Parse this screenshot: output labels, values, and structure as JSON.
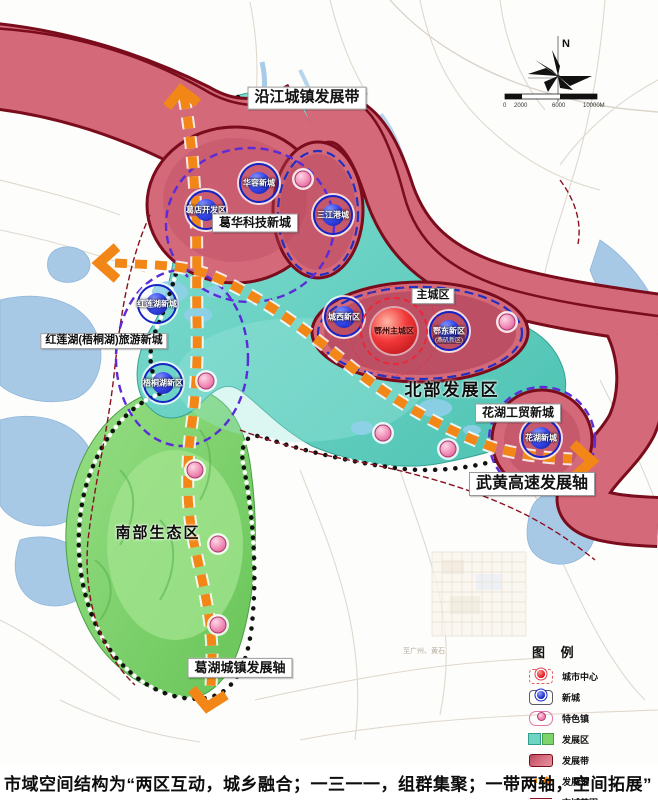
{
  "map": {
    "belt_label": "沿江城镇发展带",
    "regions": {
      "main_city": "主城区",
      "north": "北部发展区",
      "south": "南部生态区"
    },
    "clusters": {
      "gehua": "葛华科技新城",
      "honglianhu": "红莲湖(梧桐湖)旅游新城",
      "huahu": "花湖工贸新城"
    },
    "axes": {
      "wuhuang": "武黄高速发展轴",
      "gehu": "葛湖城镇发展轴"
    },
    "city_center": {
      "label": "鄂州主城区"
    },
    "new_cities": [
      {
        "label": "葛店开发区"
      },
      {
        "label": "华容新城"
      },
      {
        "label": "三江港城"
      },
      {
        "label": "城西新区"
      },
      {
        "label": "鄂东新区",
        "sub_label": "(燕矶新区)"
      },
      {
        "label": "红莲湖新城"
      },
      {
        "label": "梧桐湖新区"
      },
      {
        "label": "花湖新城"
      }
    ],
    "road_label": "至广州、黄石"
  },
  "compass": {
    "north": "N"
  },
  "scalebar": {
    "ticks": [
      "0",
      "2000",
      "6000",
      "10000M"
    ]
  },
  "legend": {
    "title": "图 例",
    "items": [
      {
        "label": "城市中心"
      },
      {
        "label": "新城"
      },
      {
        "label": "特色镇"
      },
      {
        "label": "发展区"
      },
      {
        "label": "发展带"
      },
      {
        "label": "发展轴"
      },
      {
        "label": "市域范围"
      }
    ]
  },
  "caption": "市域空间结构为“两区互动，城乡融合；一三一一，组群集聚；一带两轴，空间拓展”",
  "colors": {
    "belt_fill": "#d4697a",
    "belt_border": "#7a0c1c",
    "north_region": "#5ecbbb",
    "south_region": "#7fd36b",
    "axis_orange": "#f28718",
    "new_city_blue": "#1525c5",
    "city_center_red": "#e01020",
    "town_pink": "#ee7fae",
    "cluster_dash_purple": "#5b2bd8",
    "boundary_dark_red": "#8a1020",
    "water_blue": "#a8c9e6"
  }
}
